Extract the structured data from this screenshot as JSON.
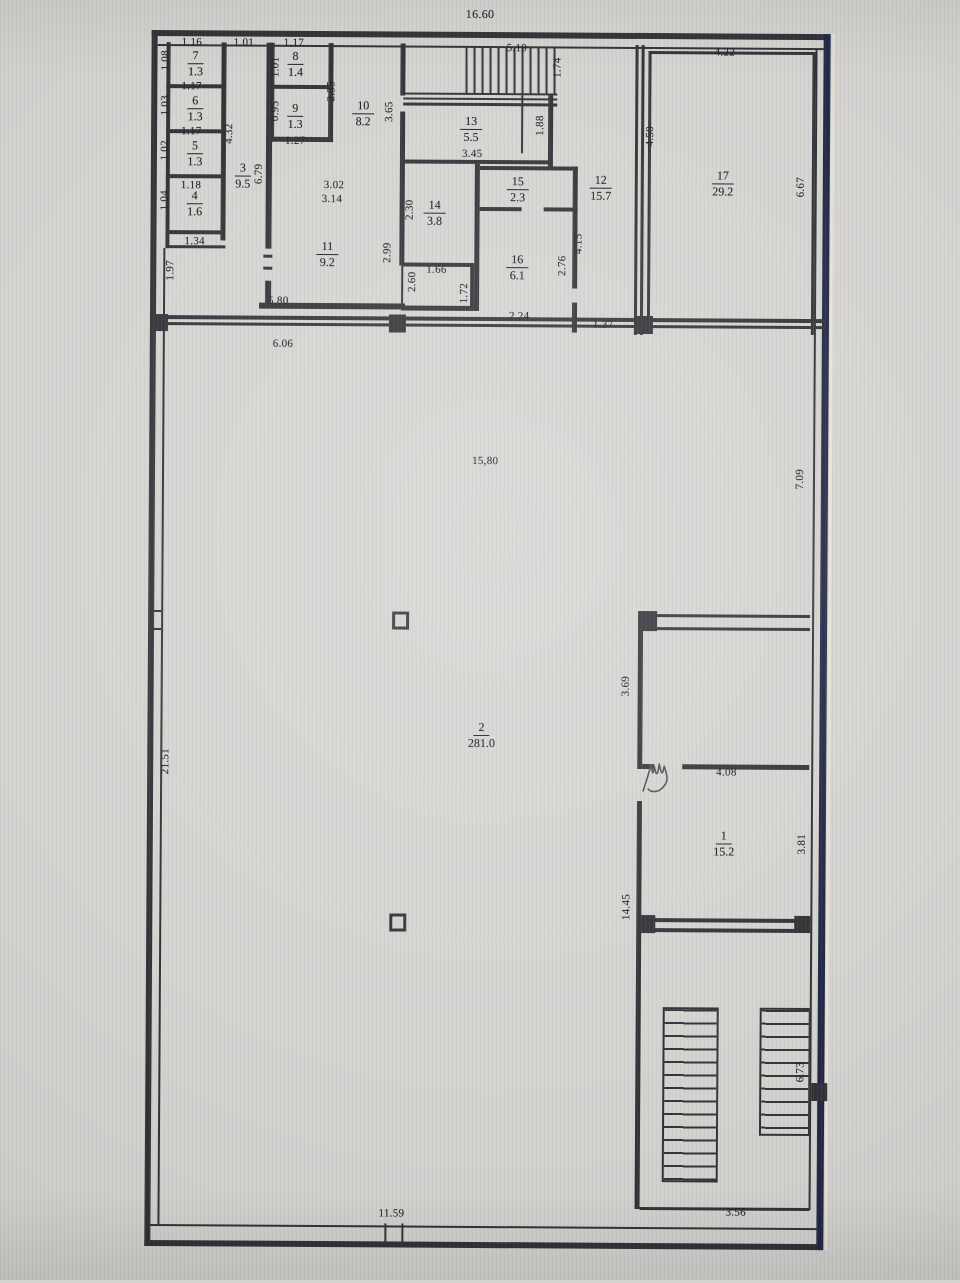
{
  "meta": {
    "kind": "apartment-floor-plan",
    "paper_color": "#d3d2cf",
    "line_color": "#2b2b31",
    "right_border_color": "#1d2140"
  },
  "rooms": {
    "1": {
      "n": "1",
      "a": "15.2"
    },
    "2": {
      "n": "2",
      "a": "281.0"
    },
    "3": {
      "n": "3",
      "a": "9.5"
    },
    "4": {
      "n": "4",
      "a": "1.6"
    },
    "5": {
      "n": "5",
      "a": "1.3"
    },
    "6": {
      "n": "6",
      "a": "1.3"
    },
    "7": {
      "n": "7",
      "a": "1.3"
    },
    "8": {
      "n": "8",
      "a": "1.4"
    },
    "9": {
      "n": "9",
      "a": "1.3"
    },
    "10": {
      "n": "10",
      "a": "8.2"
    },
    "11": {
      "n": "11",
      "a": "9.2"
    },
    "12": {
      "n": "12",
      "a": "15.7"
    },
    "13": {
      "n": "13",
      "a": "5.5"
    },
    "14": {
      "n": "14",
      "a": "3.8"
    },
    "15": {
      "n": "15",
      "a": "2.3"
    },
    "16": {
      "n": "16",
      "a": "6.1"
    },
    "17": {
      "n": "17",
      "a": "29.2"
    }
  },
  "dims": {
    "w_total": "16.60",
    "r7_w": "1.16",
    "r7_h": "1.08",
    "r6_w": "1.17",
    "r6_h": "1.03",
    "r5_w": "1.17",
    "r5_h": "1.02",
    "r4_w": "1.18",
    "r4_h": "1.04",
    "strip": "1.34",
    "corr_top": "1.01",
    "corr_h": "6.79",
    "corr_side": "4.32",
    "r8_w": "1.17",
    "r8_h": "1.01",
    "r9_h": "0.95",
    "r9_w": "1.27",
    "r89_side": "2.35",
    "r10_side": "3.65",
    "stair_top": "5.19",
    "r11_w1": "3.02",
    "r11_w2": "3.14",
    "r13_w": "3.45",
    "r13_s1": "1.88",
    "r13_s2": "1.74",
    "shaft": "4.50",
    "r17_w": "4.22",
    "r17_e": "6.67",
    "r11_bottom": "5.80",
    "hall_top": "6.06",
    "left_gap": "1.97",
    "r11_e": "2.99",
    "vest_w": "1.66",
    "vest_h": "2.60",
    "vest_h2": "1.72",
    "r14_side": "2.30",
    "r16_w": "2.24",
    "r16_e": "2.76",
    "r12_w": "4.15",
    "gap_w": "1.37",
    "hall_w": "15,80",
    "hall_left": "21.51",
    "hall_right": "7.09",
    "rb_top": "3.69",
    "r1_top": "4.08",
    "r1_e": "3.81",
    "rb_left": "14.45",
    "stair_e": "6.73",
    "stair_w": "3.56",
    "bottom_w": "11.59"
  }
}
